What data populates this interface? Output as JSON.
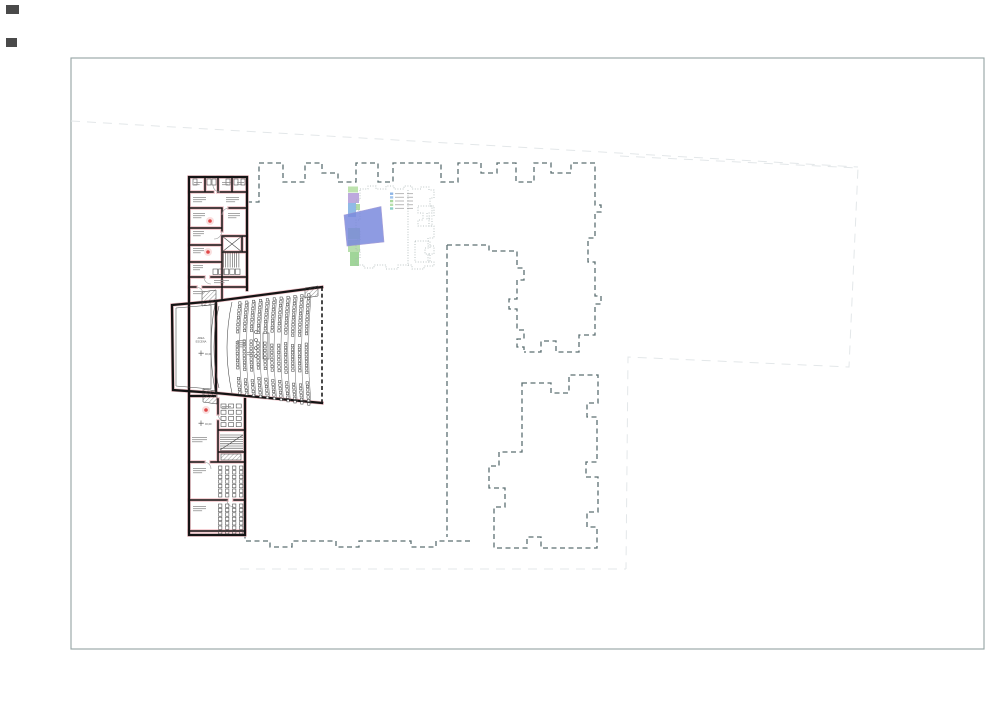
{
  "sheet": {
    "background": "#ffffff",
    "border_color": "#93a3a3",
    "content_type": "architectural floor plan — theatre / auditorium level with site outline"
  },
  "palette": {
    "wall_ink": "#141414",
    "wall_glow": "#f0c0c6",
    "dash_dark": "#5c6f72",
    "faint": "#e3e7e9",
    "inset_dotted": "#a9b4b4",
    "overlay_blue": "#7b8add",
    "green1": "#b7e0a6",
    "green2": "#a2d796",
    "green3": "#96d08e",
    "green4": "#b0dca4",
    "purple": "#b6a0da",
    "blue": "#84b2e4",
    "legend_blue1": "#8db4e6",
    "legend_blue2": "#9fc3ec",
    "legend_green1": "#a8d89c",
    "legend_green2": "#b9e0ac",
    "legend_teal": "#8ccfc6",
    "red_dot": "#e04848",
    "red_halo": "#f2b9b9",
    "seat": "#3c3c3c",
    "micro_text": "#8a8a8a",
    "border": "#93a3a3"
  },
  "labels": {
    "stage_line1": "AREA",
    "stage_line2": "ESCENA",
    "level_marker": "±0,00"
  },
  "structure": {
    "auditorium": {
      "seat_rows": 11,
      "seat_banks": 3,
      "approx_seats": 290
    },
    "keyplan_legend_rows": 5,
    "classroom_grids": [
      {
        "cols": 4,
        "rows": 7
      },
      {
        "cols": 4,
        "rows": 7
      }
    ],
    "rehearsal_room_grid": {
      "cols": 3,
      "rows": 4
    }
  }
}
